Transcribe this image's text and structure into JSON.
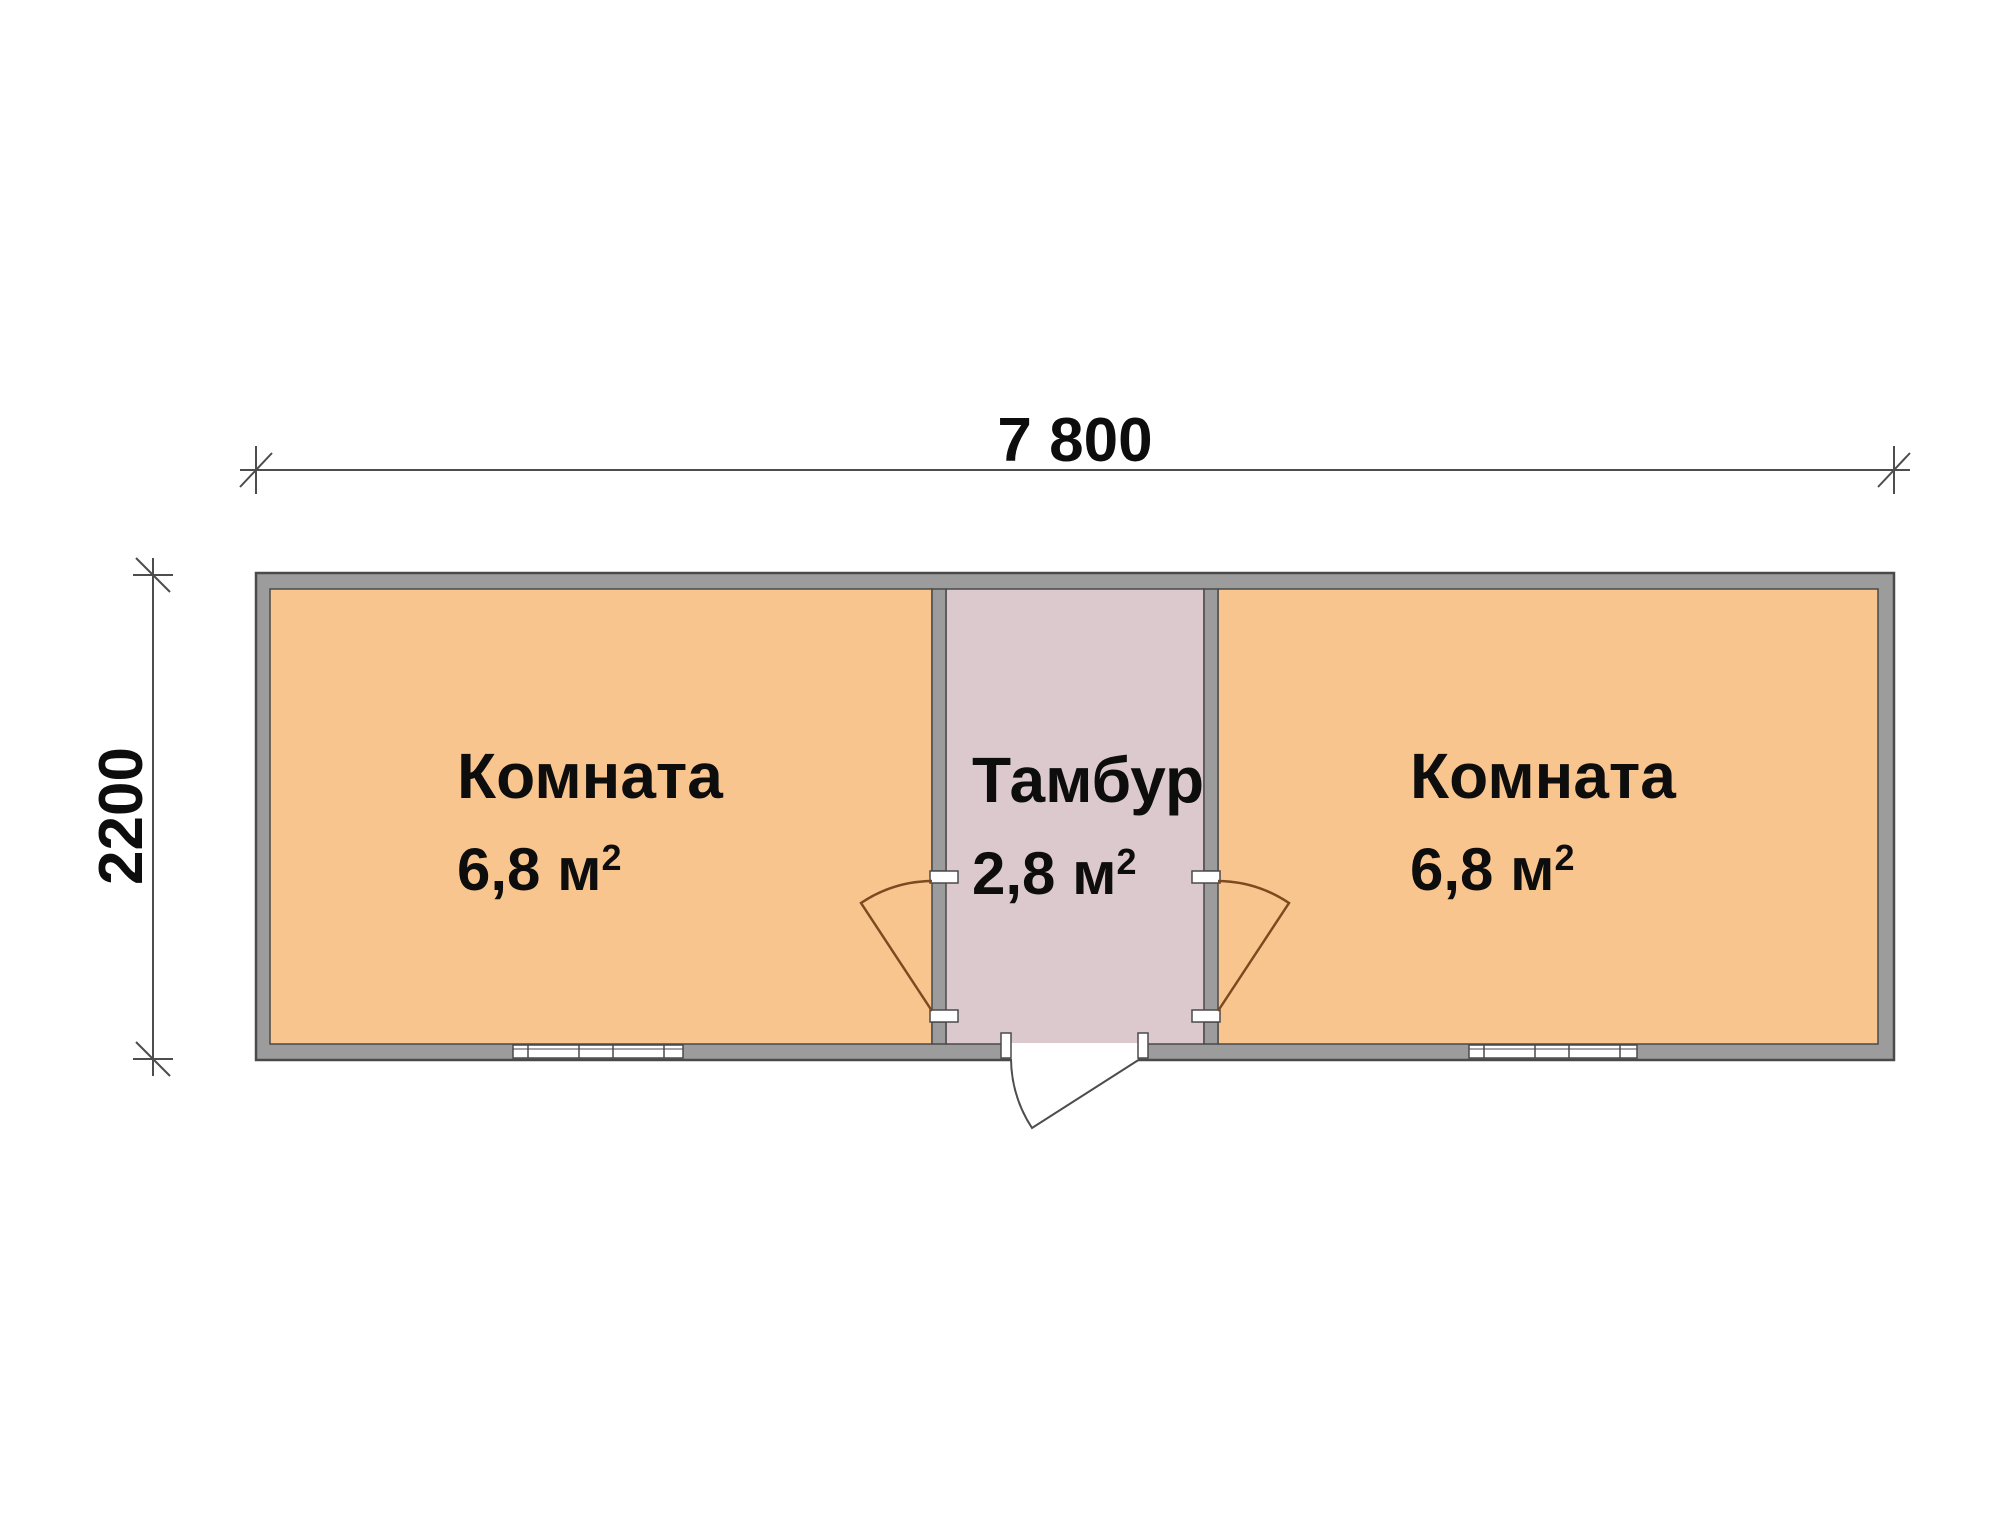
{
  "dimensions": {
    "width_label": "7 800",
    "height_label": "2200"
  },
  "rooms": [
    {
      "name": "Комната",
      "area_label": "6,8 м",
      "area_sup": "2"
    },
    {
      "name": "Тамбур",
      "area_label": "2,8 м",
      "area_sup": "2"
    },
    {
      "name": "Комната",
      "area_label": "6,8 м",
      "area_sup": "2"
    }
  ],
  "colors": {
    "room_fill": "#F9C58F",
    "vestibule_fill": "#DCC9CE",
    "wall_fill": "#9C9C9C",
    "wall_outline": "#4A4A4A",
    "door_swing": "#7B4A1F",
    "entry_door": "#4D4D4D",
    "dimension_line": "#4D4D4D",
    "window_frame": "#4A4A4A",
    "text": "#0D0D0D"
  }
}
